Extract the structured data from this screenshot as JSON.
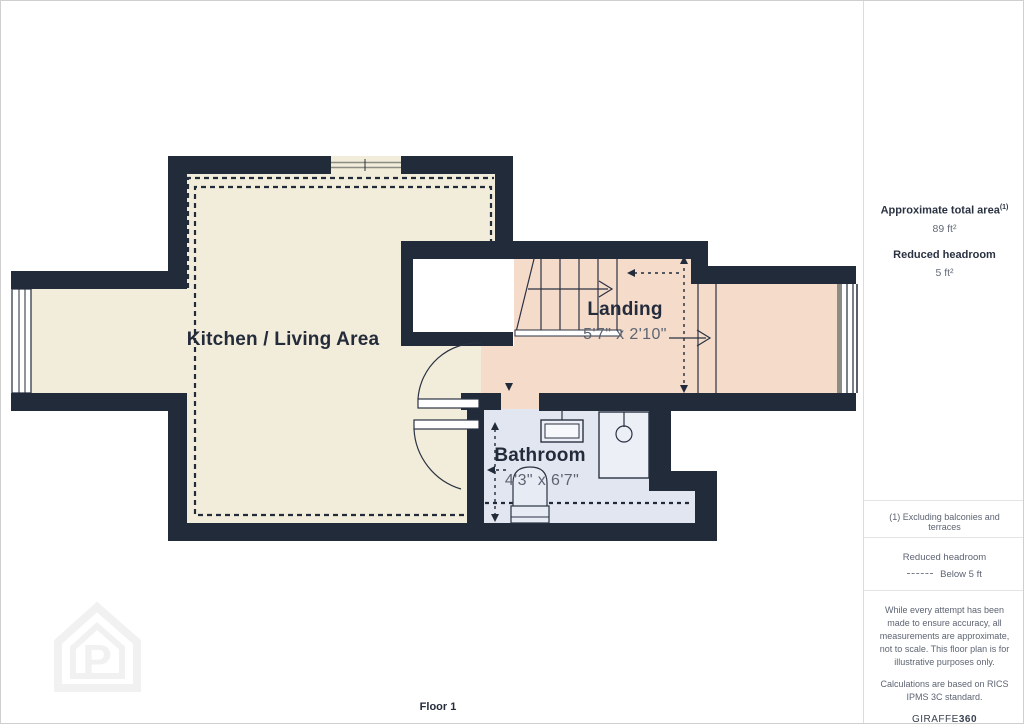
{
  "plan": {
    "floor_label": "Floor 1",
    "watermark_letter": "P",
    "rooms": [
      {
        "name": "Kitchen / Living Area",
        "dimensions": ""
      },
      {
        "name": "Landing",
        "dimensions": "5'7\" x 2'10\""
      },
      {
        "name": "Bathroom",
        "dimensions": "4'3\" x 6'7\""
      }
    ],
    "colors": {
      "wall": "#222b3a",
      "kitchen_floor": "#f2edda",
      "landing_floor": "#f5dbca",
      "bathroom_floor": "#e2e6f0",
      "line": "#2a3242"
    }
  },
  "sidebar": {
    "approx_area_label": "Approximate total area",
    "approx_area_sup": "(1)",
    "approx_area_value": "89 ft²",
    "reduced_headroom_label": "Reduced headroom",
    "reduced_headroom_value": "5 ft²",
    "note": "(1) Excluding balconies and terraces",
    "legend_title": "Reduced headroom",
    "legend_item": "Below 5 ft",
    "disclaimer1": "While every attempt has been made to ensure accuracy, all measurements are approximate, not to scale. This floor plan is for illustrative purposes only.",
    "disclaimer2": "Calculations are based on RICS IPMS 3C standard.",
    "brand_name": "GIRAFFE",
    "brand_suffix": "360"
  }
}
